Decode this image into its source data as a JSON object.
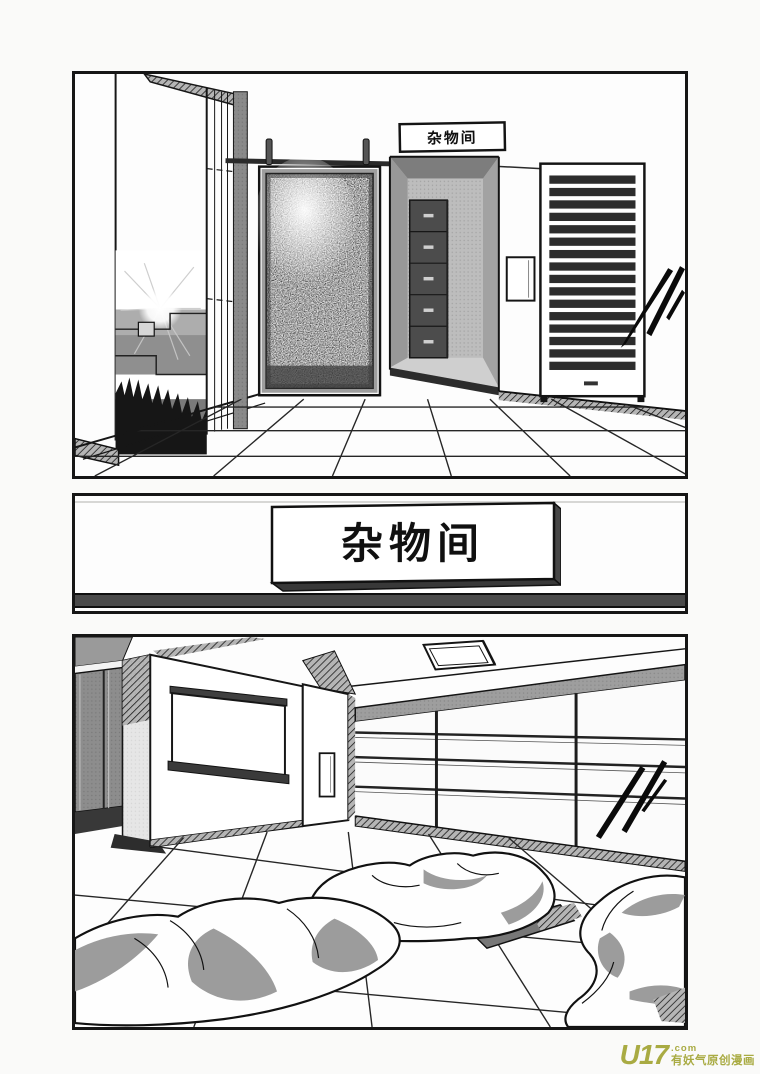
{
  "page": {
    "kind": "manga page, three black-bordered panels",
    "background_color": "#fafaf9",
    "panel_border_color": "#161616",
    "ink_color": "#1a1a1a",
    "tone_gray": "#9c9c9c"
  },
  "panels": [
    {
      "name": "hallway with sliding door, cabinet alcove and louver shutter",
      "sign_label": "杂物间"
    },
    {
      "name": "close-up of the door sign plate",
      "sign_label": "杂物间"
    },
    {
      "name": "storeroom interior with futons on tiled floor"
    }
  ],
  "watermark": {
    "logo": "U17",
    "logo_suffix": ".com",
    "tagline": "有妖气原创漫画",
    "color": "#a9ab43"
  }
}
